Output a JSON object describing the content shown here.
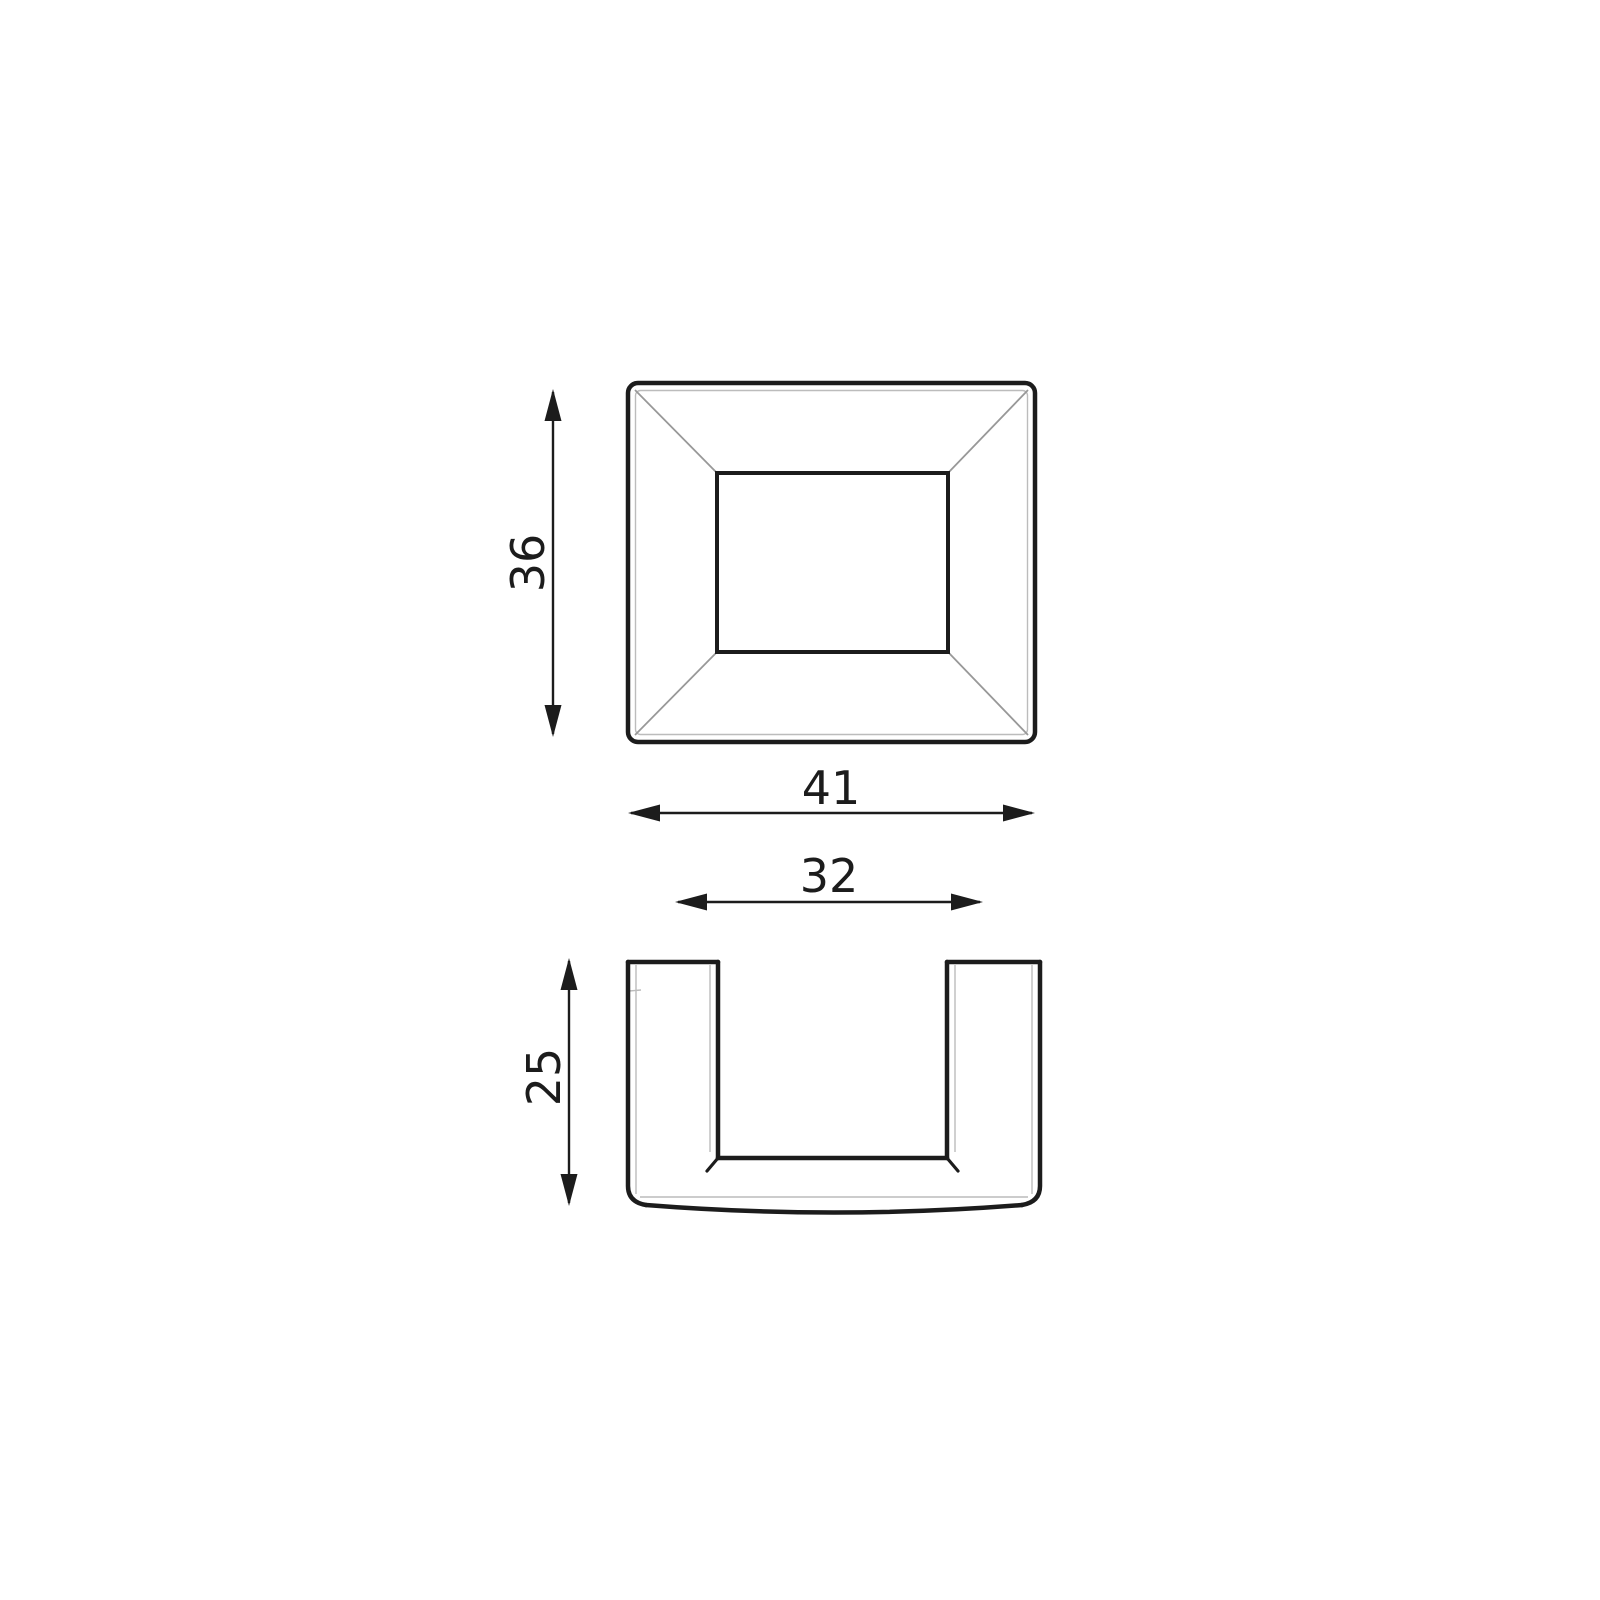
{
  "drawing": {
    "background_color": "#ffffff",
    "colors": {
      "line": "#1c1c1c",
      "dimension": "#1c1c1c",
      "diagonal_edge": "#989898",
      "thin_edge": "#bcbcbc"
    },
    "views": {
      "top": {
        "dimensions": {
          "height": {
            "label": "36"
          },
          "width": {
            "label": "41"
          }
        }
      },
      "front": {
        "dimensions": {
          "inner_width": {
            "label": "32"
          },
          "height": {
            "label": "25"
          }
        }
      }
    }
  }
}
